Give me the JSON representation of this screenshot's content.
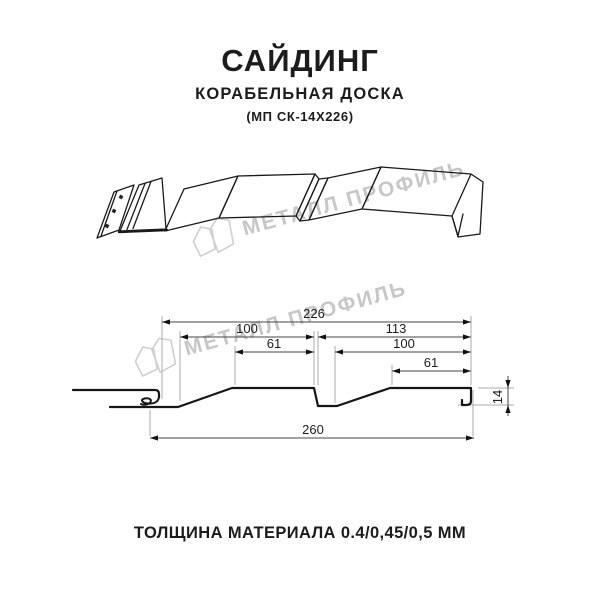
{
  "header": {
    "title": "САЙДИНГ",
    "subtitle": "КОРАБЕЛЬНАЯ ДОСКА",
    "model": "(МП СК-14Х226)"
  },
  "watermark": {
    "text": "МЕТАЛЛ ПРОФИЛЬ",
    "color": "#c7c7c7"
  },
  "dimensions": {
    "working_width": "226",
    "pitch_left": "100",
    "pitch_right": "113",
    "flat_left": "61",
    "flat_right_pitch": "100",
    "flat_right": "61",
    "overall_width": "260",
    "profile_height": "14"
  },
  "footer": {
    "thickness": "ТОЛЩИНА МАТЕРИАЛА 0.4/0,45/0,5 ММ"
  },
  "colors": {
    "profile_line": "#161616",
    "dim_line": "#444444",
    "ext_line": "#ababab",
    "text": "#1c1c1c",
    "watermark": "#c7c7c7"
  }
}
